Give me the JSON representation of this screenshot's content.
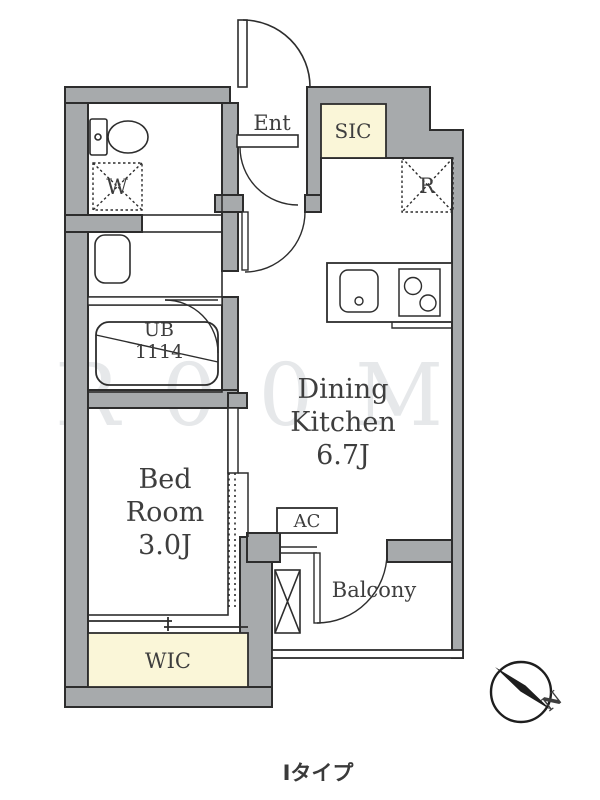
{
  "caption": "Iタイプ",
  "watermark": "R00M",
  "colors": {
    "wall_gray": "#a7aaac",
    "closet_cream": "#faf6d8",
    "line": "#2d2d2d",
    "label_text": "#3e3e3e"
  },
  "rooms": {
    "entrance": {
      "label": "Ent"
    },
    "dining_kitchen": {
      "line1": "Dining",
      "line2": "Kitchen",
      "size": "6.7J"
    },
    "bed_room": {
      "line1": "Bed",
      "line2": "Room",
      "size": "3.0J"
    },
    "unit_bath": {
      "line1": "UB",
      "line2": "1114"
    },
    "balcony": {
      "label": "Balcony"
    }
  },
  "storage": {
    "shoe_closet": {
      "label": "SIC"
    },
    "walk_in_closet": {
      "label": "WIC"
    }
  },
  "fixtures": {
    "washer_spot": {
      "label": "W"
    },
    "refrigerator_spot": {
      "label": "R"
    },
    "air_conditioner": {
      "label": "AC"
    }
  },
  "compass": {
    "north": "N"
  }
}
